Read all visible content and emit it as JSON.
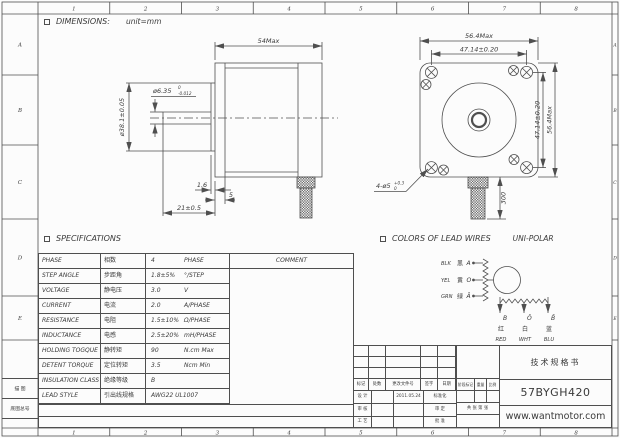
{
  "frame": {
    "top_zones": [
      "1",
      "2",
      "3",
      "4",
      "5",
      "6",
      "7",
      "8"
    ],
    "bottom_zones": [
      "1",
      "2",
      "3",
      "4",
      "5",
      "6",
      "7",
      "8"
    ],
    "left_zones": [
      "A",
      "B",
      "C",
      "D",
      "E"
    ],
    "right_zones": [
      "A",
      "B",
      "C",
      "D",
      "E"
    ],
    "corner_cells": [
      "描 图",
      "底图总号"
    ]
  },
  "dimensions": {
    "section_title": "DIMENSIONS:",
    "unit_note": "unit=mm",
    "side_view": {
      "body_length": "54Max",
      "shaft_dia": "ø6.35",
      "shaft_tol_upper": "0",
      "shaft_tol_lower": "-0.012",
      "pilot_dia": "ø38.1±0.05",
      "boss_height": "1.6",
      "flange_thickness": "5",
      "shaft_length": "21±0.5"
    },
    "front_view": {
      "body_width": "56.4Max",
      "hole_pitch_h": "47.14±0.20",
      "hole_pitch_v": "47.14±0.20",
      "body_height": "56.4Max",
      "hole_callout": "4-ø5",
      "hole_tol_upper": "+0.3",
      "hole_tol_lower": "0",
      "lead_length": "300"
    }
  },
  "specifications": {
    "section_title": "SPECIFICATIONS",
    "comment_header": "COMMENT",
    "rows": [
      {
        "en": "PHASE",
        "cn": "相数",
        "value": "4",
        "unit": "PHASE"
      },
      {
        "en": "STEP ANGLE",
        "cn": "步距角",
        "value": "1.8±5%",
        "unit": "°/STEP"
      },
      {
        "en": "VOLTAGE",
        "cn": "静电压",
        "value": "3.0",
        "unit": "V"
      },
      {
        "en": "CURRENT",
        "cn": "电流",
        "value": "2.0",
        "unit": "A/PHASE"
      },
      {
        "en": "RESISTANCE",
        "cn": "电阻",
        "value": "1.5±10%",
        "unit": "Ω/PHASE"
      },
      {
        "en": "INDUCTANCE",
        "cn": "电感",
        "value": "2.5±20%",
        "unit": "mH/PHASE"
      },
      {
        "en": "HOLDING TOGQUE",
        "cn": "静转矩",
        "value": "90",
        "unit": "N.cm Max"
      },
      {
        "en": "DETENT TORQUE",
        "cn": "定位转矩",
        "value": "3.5",
        "unit": "Ncm Min"
      },
      {
        "en": "INSULATION CLASS",
        "cn": "绝缘等级",
        "value": "B",
        "unit": ""
      },
      {
        "en": "LEAD STYLE",
        "cn": "引出线规格",
        "value": "AWG22 UL1007",
        "unit": ""
      }
    ]
  },
  "lead_wires": {
    "section_title": "COLORS OF LEAD WIRES",
    "subtitle": "UNI-POLAR",
    "left_wires": [
      {
        "abbr": "BLK",
        "cn": "黑",
        "terminal": "A"
      },
      {
        "abbr": "YEL",
        "cn": "黄",
        "terminal": "O"
      },
      {
        "abbr": "GRN",
        "cn": "绿",
        "terminal": "Ā"
      }
    ],
    "bottom_wires": [
      {
        "terminal": "B",
        "cn": "红",
        "abbr": "RED"
      },
      {
        "terminal": "Ō",
        "cn": "白",
        "abbr": "WHT"
      },
      {
        "terminal": "B̄",
        "cn": "蓝",
        "abbr": "BLU"
      }
    ]
  },
  "title_block": {
    "doc_type": "技术规格书",
    "model": "57BYGH420",
    "website": "www.wantmotor.com",
    "rev_headers": [
      "标记",
      "处数",
      "更改文件号",
      "签字",
      "日期"
    ],
    "sign_rows": [
      {
        "label": "设 计",
        "date": "2011.05.24",
        "right": "标准化"
      },
      {
        "label": "审 核",
        "date": "",
        "right": "审 定"
      },
      {
        "label": "工 艺",
        "date": "",
        "right": "批 准"
      }
    ],
    "stage_headers": [
      "阶段标记",
      "重量",
      "比例"
    ],
    "sheet_note": "共 张 第 张"
  }
}
